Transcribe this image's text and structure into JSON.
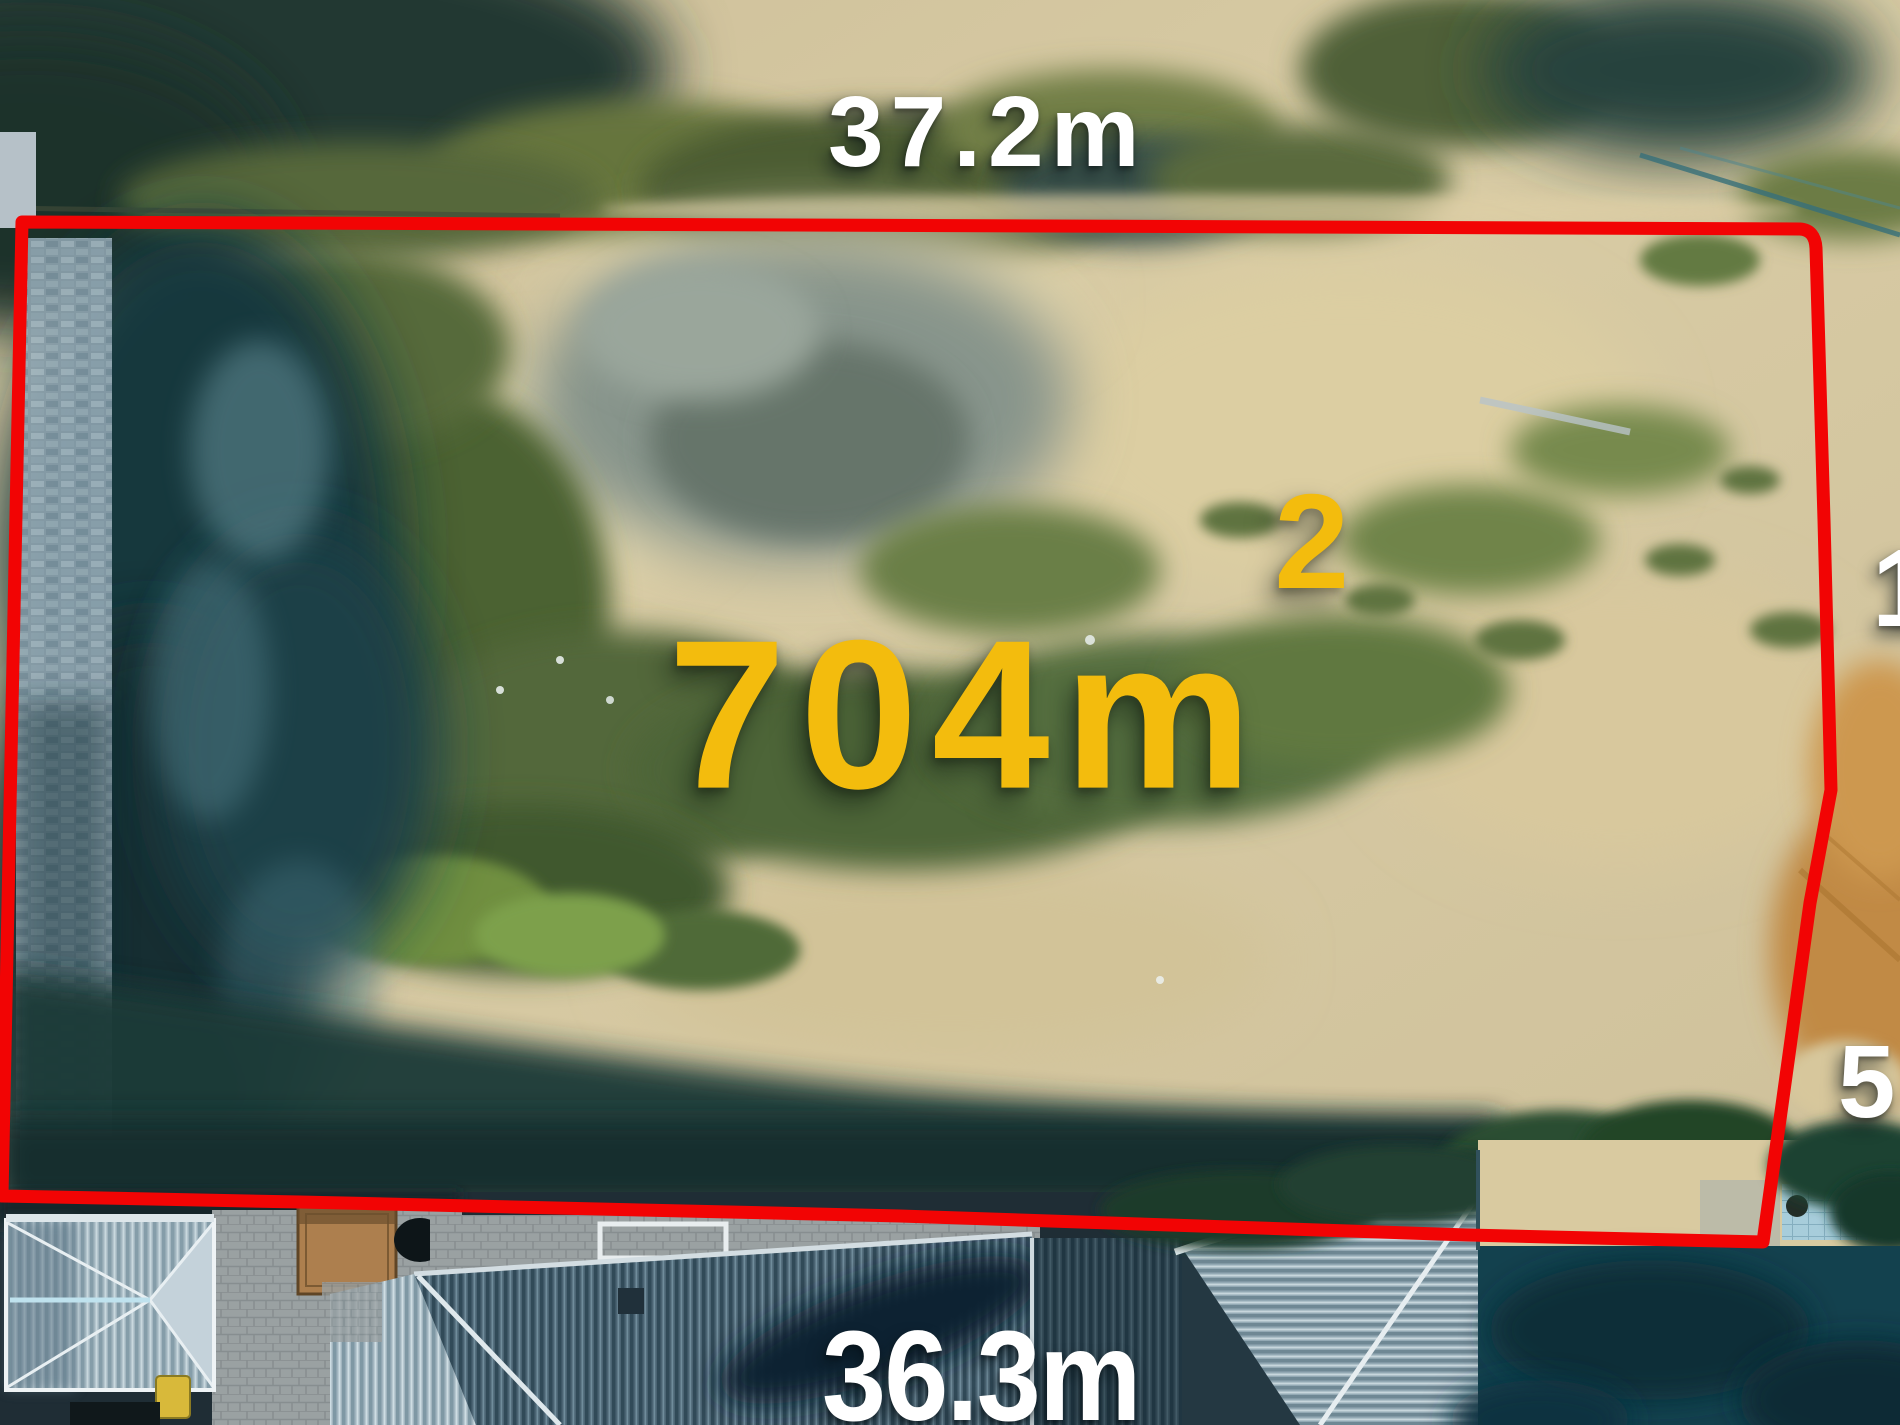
{
  "scene": {
    "description": "Aerial drone photograph of a cleared vacant residential block of land, outlined with a red survey boundary, neighbouring house roofs at the bottom of frame"
  },
  "labels": {
    "top_dimension": "37.2m",
    "bottom_dimension": "36.3m",
    "area": {
      "value": "704m",
      "superscript": "2"
    },
    "right_partial_top": "1",
    "right_partial_bottom": "5"
  },
  "colors": {
    "boundary_line": "#f20404",
    "area_text": "#f3bc0d",
    "dimension_text": "#ffffff"
  }
}
